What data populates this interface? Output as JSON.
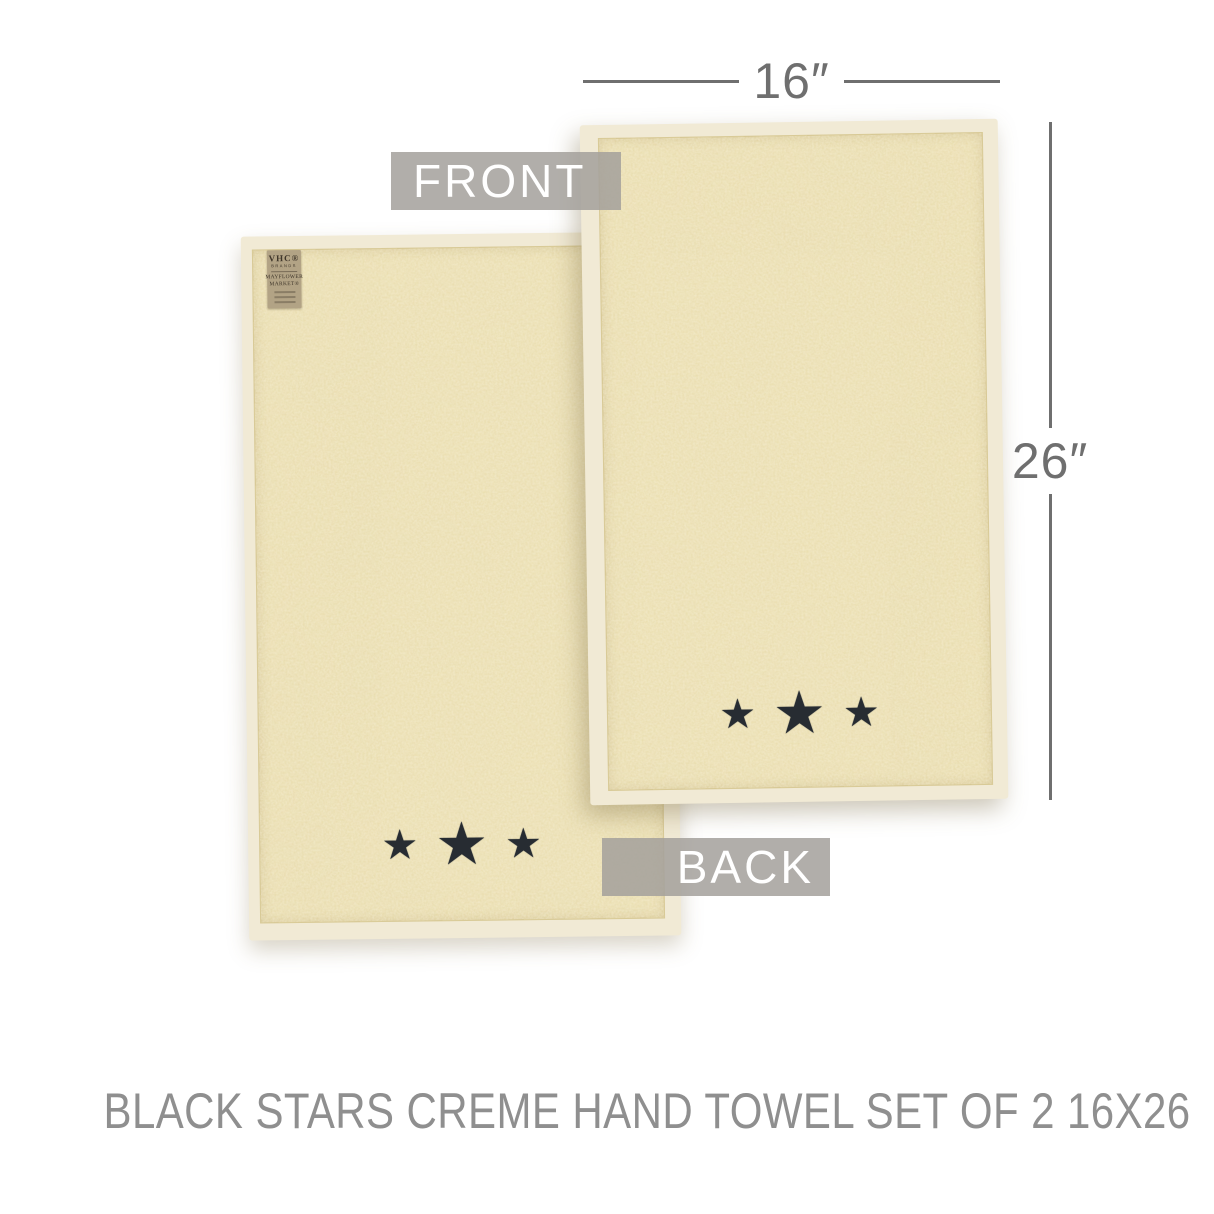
{
  "title": "BLACK STARS CREME HAND TOWEL SET OF 2 16X26",
  "dimensions": {
    "width_label": "16″",
    "height_label": "26″"
  },
  "view_labels": {
    "front": "FRONT",
    "back": "BACK"
  },
  "icons": {
    "star": "★"
  },
  "tag": {
    "brand": "VHC®",
    "brand_sub": "BRANDS",
    "collection_line1": "MAYFLOWER",
    "collection_line2": "MARKET®"
  },
  "colors": {
    "terry": "#e9dcab",
    "selvage_border": "#f1ead5",
    "star": "#272c32",
    "dimension_line": "#6f6f6f",
    "title_text": "#8f8f8f",
    "label_bg": "rgba(163,160,155,0.85)",
    "label_text": "#ffffff",
    "tag_bg": "#b2a385",
    "tag_text": "#3f362a",
    "page_bg": "#ffffff"
  }
}
